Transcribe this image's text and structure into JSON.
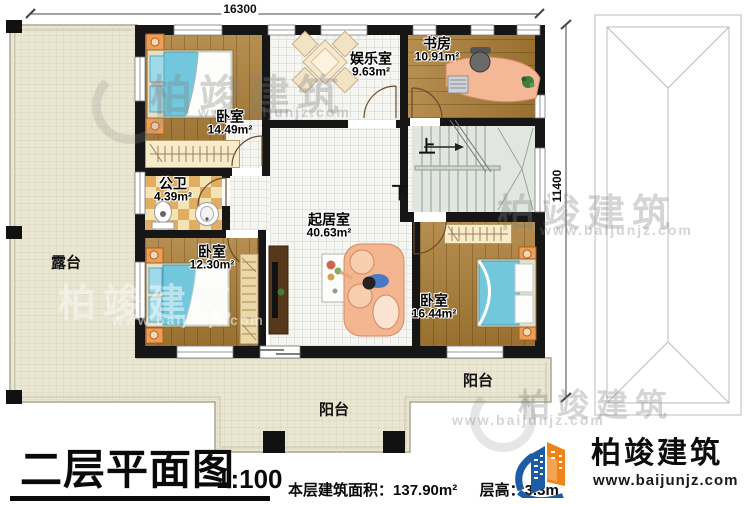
{
  "meta": {
    "title": "二层平面图",
    "scale": "1:100"
  },
  "summary": {
    "area_label": "本层建筑面积：",
    "area_value": "137.90m²",
    "height_label": "层高：",
    "height_value": "3.3m"
  },
  "dimensions": {
    "width": "16300",
    "height": "11400"
  },
  "rooms": [
    {
      "name": "卧室",
      "area": "14.49m²"
    },
    {
      "name": "娱乐室",
      "area": "9.63m²"
    },
    {
      "name": "书房",
      "area": "10.91m²"
    },
    {
      "name": "公卫",
      "area": "4.39m²"
    },
    {
      "name": "起居室",
      "area": "40.63m²"
    },
    {
      "name": "卧室",
      "area": "12.30m²"
    },
    {
      "name": "卧室",
      "area": "16.44m²"
    }
  ],
  "outdoor": {
    "terrace": "露台",
    "balcony_center": "阳台",
    "balcony_right": "阳台"
  },
  "stairs": {
    "up": "上",
    "down": "下"
  },
  "branding": {
    "company": "柏竣建筑",
    "website": "www.baijunjz.com",
    "blue": "#1c5ca5",
    "orange": "#f08419"
  },
  "watermark": {
    "text": "柏竣建筑",
    "url": "www.baijunjz.com"
  },
  "colors": {
    "wall": "#161616",
    "terrace": "#eae6d1",
    "wood": "#a97c34",
    "stairs": "#e1e7e0"
  }
}
